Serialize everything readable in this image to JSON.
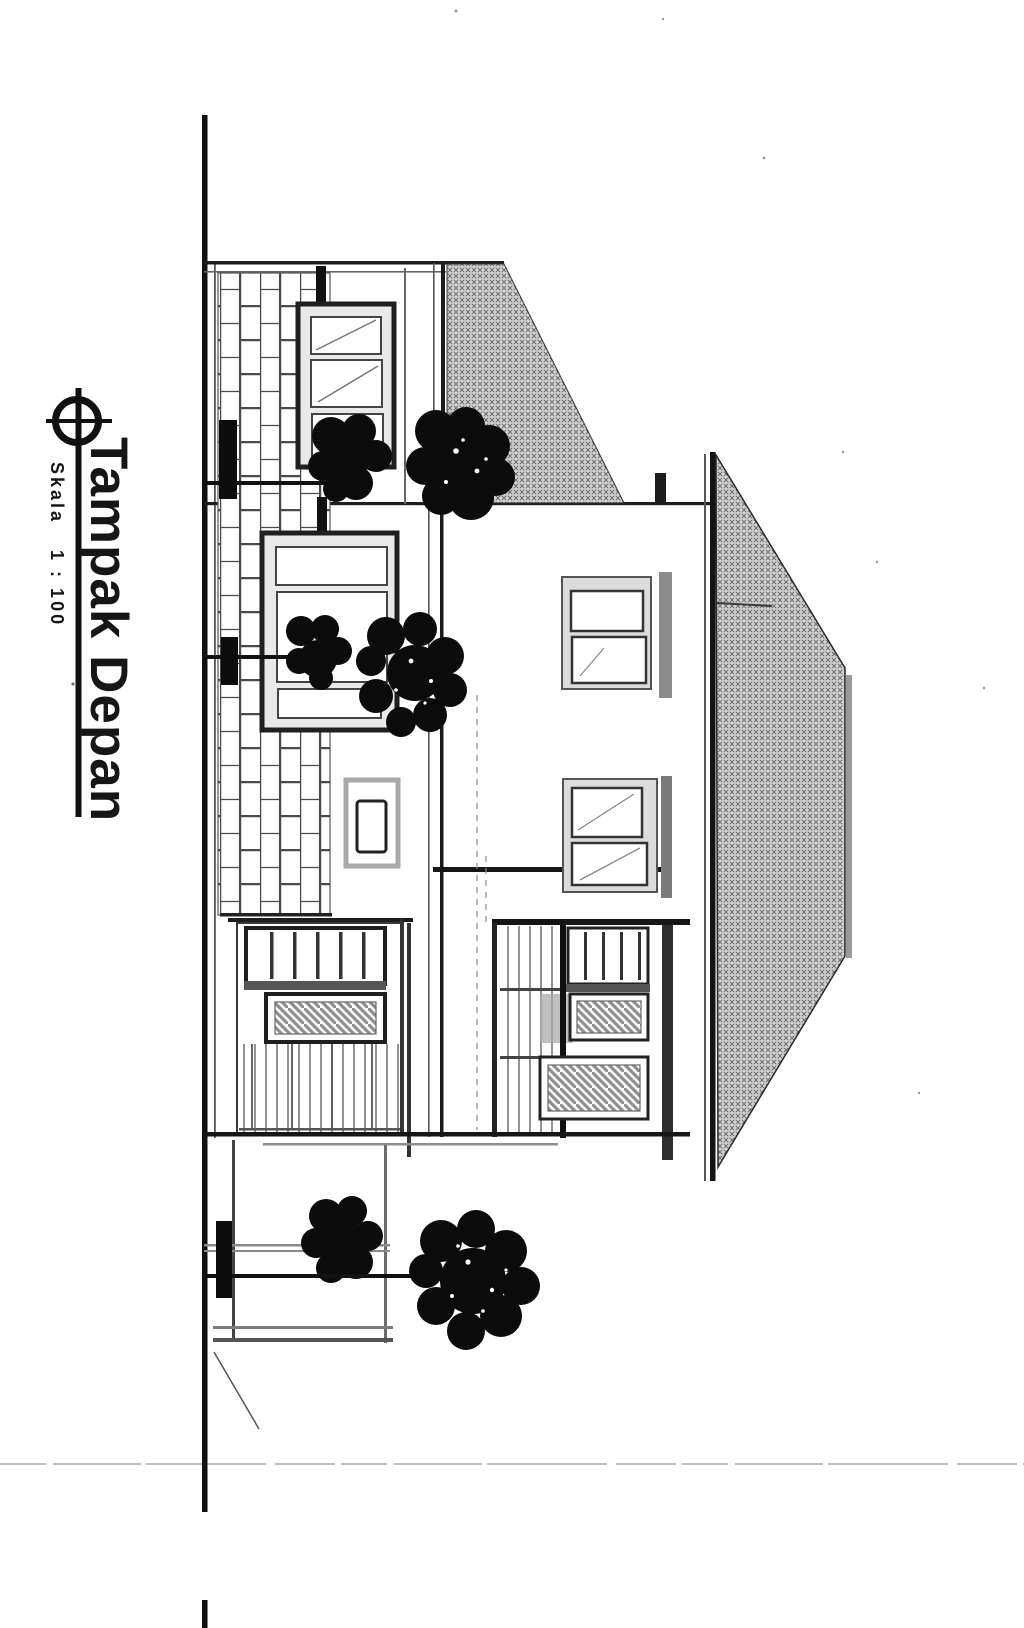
{
  "page": {
    "width_px": 1024,
    "height_px": 1628
  },
  "theme": {
    "paper": "#ffffff",
    "ink": "#161616",
    "roof_hatch_fill": "#d2d2d2",
    "frame_gray": "#dcdcdc",
    "shadow_gray": "#9b9b9b"
  },
  "title_block": {
    "marker_icon": "crosshair-circle-icon",
    "title": "Tampak Depan",
    "scale_label": "Skala",
    "scale_value": "1 : 100",
    "text_rotation_deg": 90
  },
  "drawing": {
    "type": "architectural-front-elevation",
    "note_orientation": "drawing and labels are rotated 90 degrees on the scanned page"
  }
}
